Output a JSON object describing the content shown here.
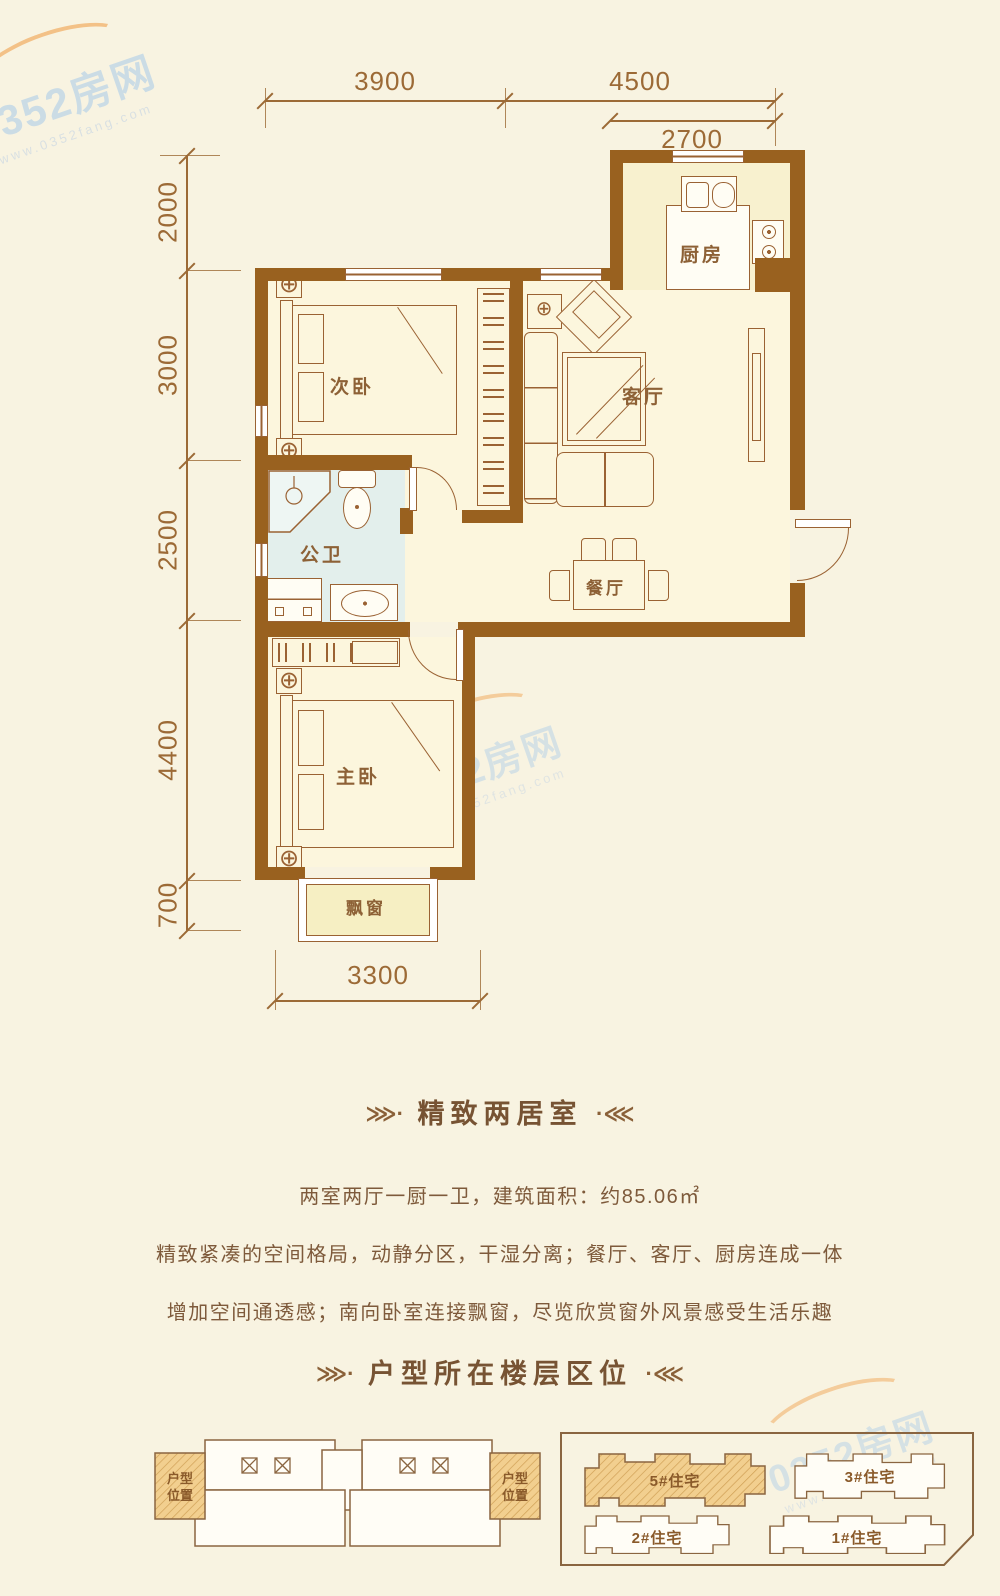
{
  "watermark": {
    "brand": "0352房网",
    "url": "www.0352fang.com"
  },
  "plan": {
    "dims": {
      "top1": "3900",
      "top2": "4500",
      "top3": "2700",
      "left1": "2000",
      "left2": "3000",
      "left3": "2500",
      "left4": "4400",
      "left5": "700",
      "bottom": "3300"
    },
    "rooms": {
      "kitchen": "厨房",
      "living": "客厅",
      "bedroom2": "次卧",
      "bath": "公卫",
      "dining": "餐厅",
      "master": "主卧",
      "bay": "飘窗"
    }
  },
  "info": {
    "title": "精致两居室",
    "line1": "两室两厅一厨一卫，建筑面积：约85.06㎡",
    "line2": "精致紧凑的空间格局，动静分区，干湿分离；餐厅、客厅、厨房连成一体",
    "line3": "增加空间通透感；南向卧室连接飘窗，尽览欣赏窗外风景感受生活乐趣",
    "title2": "户型所在楼层区位",
    "orn_left": "⋙·",
    "orn_right": "·⋘"
  },
  "floor_diagram": {
    "label_line1": "户型",
    "label_line2": "位置"
  },
  "site_plan": {
    "buildings": [
      {
        "name": "5#住宅",
        "highlighted": true
      },
      {
        "name": "3#住宅",
        "highlighted": false
      },
      {
        "name": "2#住宅",
        "highlighted": false
      },
      {
        "name": "1#住宅",
        "highlighted": false
      }
    ]
  },
  "icons": {
    "elevator": "⊠",
    "nightstand_lamp": "⊕"
  },
  "colors": {
    "wall": "#99611f",
    "highlight": "#f2cf8f",
    "bath_floor": "#e3efec",
    "line": "#9a6233",
    "text": "#7e5a3b",
    "watermark_blue": "#b9d3e8",
    "swoosh": "#f2ad62"
  }
}
